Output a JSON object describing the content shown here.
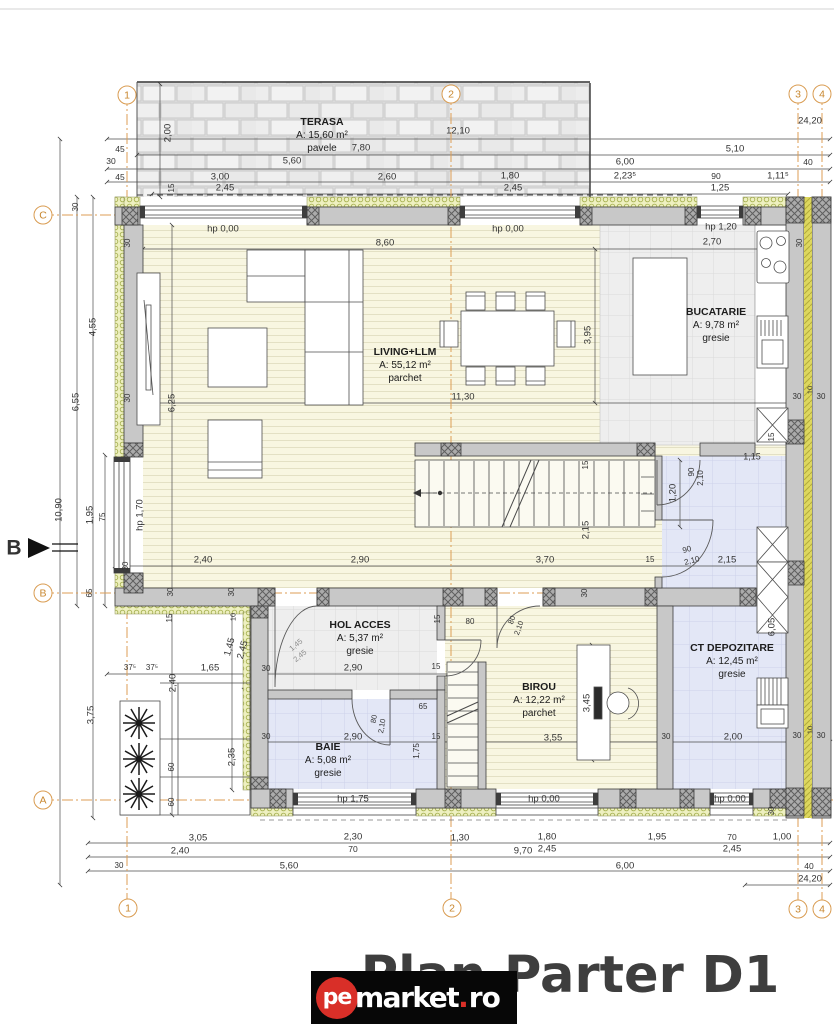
{
  "title": "Plan Parter D1",
  "watermark": {
    "circle_text": "pe",
    "name": "market",
    "tld_dot": ".",
    "tld": "ro"
  },
  "colors": {
    "axis_orange": "#dd9e55",
    "title_gray": "#3e3e3e",
    "watermark_red": "#d92f28",
    "floor_cream": "#f8f6e1",
    "floor_blue": "#e3e7f6",
    "wall_gray": "#c8c8c8",
    "insulation_green": "#eef0c0"
  },
  "grid_bubbles": [
    {
      "label": "1",
      "x": 127,
      "y": 95
    },
    {
      "label": "2",
      "x": 451,
      "y": 94
    },
    {
      "label": "3",
      "x": 798,
      "y": 94
    },
    {
      "label": "4",
      "x": 822,
      "y": 94
    },
    {
      "label": "C",
      "x": 43,
      "y": 215
    },
    {
      "label": "B",
      "x": 43,
      "y": 593
    },
    {
      "label": "A",
      "x": 43,
      "y": 800
    },
    {
      "label": "1",
      "x": 128,
      "y": 908
    },
    {
      "label": "2",
      "x": 452,
      "y": 908
    },
    {
      "label": "3",
      "x": 798,
      "y": 909
    },
    {
      "label": "4",
      "x": 822,
      "y": 909
    }
  ],
  "rooms": [
    {
      "name": "TERASA",
      "area": "A: 15,60 m²",
      "floor": "pavele",
      "x": 322,
      "y": 116
    },
    {
      "name": "LIVING+LLM",
      "area": "A: 55,12 m²",
      "floor": "parchet",
      "x": 405,
      "y": 346
    },
    {
      "name": "BUCATARIE",
      "area": "A: 9,78 m²",
      "floor": "gresie",
      "x": 716,
      "y": 306
    },
    {
      "name": "HOL ACCES",
      "area": "A: 5,37 m²",
      "floor": "gresie",
      "x": 360,
      "y": 619
    },
    {
      "name": "BAIE",
      "area": "A: 5,08 m²",
      "floor": "gresie",
      "x": 328,
      "y": 741
    },
    {
      "name": "BIROU",
      "area": "A: 12,22 m²",
      "floor": "parchet",
      "x": 539,
      "y": 681
    },
    {
      "name": "CT DEPOZITARE",
      "area": "A: 12,45 m²",
      "floor": "gresie",
      "x": 732,
      "y": 642
    }
  ],
  "labels": [
    {
      "t": "12,10",
      "x": 458,
      "y": 131
    },
    {
      "t": "24,20",
      "x": 810,
      "y": 121
    },
    {
      "t": "2,00",
      "x": 168,
      "y": 133,
      "r": -90
    },
    {
      "t": "7,80",
      "x": 361,
      "y": 148
    },
    {
      "t": "5,10",
      "x": 735,
      "y": 149
    },
    {
      "t": "45",
      "x": 120,
      "y": 149,
      "s": 8.5
    },
    {
      "t": "30",
      "x": 111,
      "y": 161,
      "s": 8.5
    },
    {
      "t": "5,60",
      "x": 292,
      "y": 161
    },
    {
      "t": "6,00",
      "x": 625,
      "y": 162
    },
    {
      "t": "40",
      "x": 808,
      "y": 162,
      "s": 8.5
    },
    {
      "t": "45",
      "x": 120,
      "y": 177,
      "s": 8.5
    },
    {
      "t": "3,00",
      "x": 220,
      "y": 177
    },
    {
      "t": "2,60",
      "x": 387,
      "y": 177
    },
    {
      "t": "1,80",
      "x": 510,
      "y": 176
    },
    {
      "t": "2,23⁵",
      "x": 625,
      "y": 176
    },
    {
      "t": "90",
      "x": 716,
      "y": 176,
      "s": 8.5
    },
    {
      "t": "1,11⁵",
      "x": 778,
      "y": 176
    },
    {
      "t": "2,45",
      "x": 225,
      "y": 188
    },
    {
      "t": "15",
      "x": 172,
      "y": 188,
      "r": -90,
      "s": 8
    },
    {
      "t": "2,45",
      "x": 513,
      "y": 188
    },
    {
      "t": "1,25",
      "x": 720,
      "y": 188
    },
    {
      "t": "hp 0,00",
      "x": 223,
      "y": 229
    },
    {
      "t": "hp 0,00",
      "x": 508,
      "y": 229
    },
    {
      "t": "hp 1,20",
      "x": 721,
      "y": 227
    },
    {
      "t": "2,70",
      "x": 712,
      "y": 242
    },
    {
      "t": "8,60",
      "x": 385,
      "y": 243
    },
    {
      "t": "30",
      "x": 128,
      "y": 243,
      "r": -90,
      "s": 8
    },
    {
      "t": "30",
      "x": 800,
      "y": 243,
      "r": -90,
      "s": 8
    },
    {
      "t": "30",
      "x": 76,
      "y": 207,
      "r": -90,
      "s": 8
    },
    {
      "t": "4,55",
      "x": 93,
      "y": 327,
      "r": -90
    },
    {
      "t": "6,55",
      "x": 76,
      "y": 402,
      "r": -90
    },
    {
      "t": "10,90",
      "x": 59,
      "y": 510,
      "r": -90
    },
    {
      "t": "1,95",
      "x": 90,
      "y": 515,
      "r": -90
    },
    {
      "t": "75",
      "x": 103,
      "y": 517,
      "r": -90,
      "s": 8
    },
    {
      "t": "hp 1,70",
      "x": 140,
      "y": 515,
      "r": -90
    },
    {
      "t": "3,75",
      "x": 91,
      "y": 715,
      "r": -90
    },
    {
      "t": "6,25",
      "x": 172,
      "y": 403,
      "r": -90
    },
    {
      "t": "30",
      "x": 128,
      "y": 398,
      "r": -90,
      "s": 8
    },
    {
      "t": "11,30",
      "x": 463,
      "y": 397
    },
    {
      "t": "3,95",
      "x": 588,
      "y": 335,
      "r": -90
    },
    {
      "t": "15",
      "x": 586,
      "y": 465,
      "r": -90,
      "s": 8
    },
    {
      "t": "2,15",
      "x": 586,
      "y": 530,
      "r": -90
    },
    {
      "t": "1,20",
      "x": 673,
      "y": 493,
      "r": -90
    },
    {
      "t": "90",
      "x": 692,
      "y": 472,
      "r": -90,
      "s": 8
    },
    {
      "t": "2,10",
      "x": 701,
      "y": 478,
      "r": -90,
      "s": 8
    },
    {
      "t": "1,15",
      "x": 752,
      "y": 457,
      "s": 9
    },
    {
      "t": "15",
      "x": 772,
      "y": 437,
      "r": -90,
      "s": 8
    },
    {
      "t": "90",
      "x": 687,
      "y": 550,
      "s": 8,
      "r": -15
    },
    {
      "t": "2,10",
      "x": 692,
      "y": 561,
      "s": 8,
      "r": -15
    },
    {
      "t": "10",
      "x": 810,
      "y": 390,
      "r": -90,
      "s": 7.5
    },
    {
      "t": "30",
      "x": 797,
      "y": 397,
      "s": 8
    },
    {
      "t": "30",
      "x": 821,
      "y": 397,
      "s": 8
    },
    {
      "t": "2,40",
      "x": 203,
      "y": 560
    },
    {
      "t": "2,90",
      "x": 360,
      "y": 560
    },
    {
      "t": "3,70",
      "x": 545,
      "y": 560
    },
    {
      "t": "15",
      "x": 650,
      "y": 560,
      "s": 8
    },
    {
      "t": "2,15",
      "x": 727,
      "y": 560
    },
    {
      "t": "30",
      "x": 126,
      "y": 566,
      "r": -90,
      "s": 8
    },
    {
      "t": "65",
      "x": 90,
      "y": 593,
      "r": -90,
      "s": 8
    },
    {
      "t": "30",
      "x": 171,
      "y": 592,
      "r": -90,
      "s": 8
    },
    {
      "t": "30",
      "x": 232,
      "y": 592,
      "r": -90,
      "s": 8
    },
    {
      "t": "30",
      "x": 585,
      "y": 593,
      "r": -90,
      "s": 8
    },
    {
      "t": "15",
      "x": 170,
      "y": 618,
      "r": -90,
      "s": 8
    },
    {
      "t": "10",
      "x": 233,
      "y": 617,
      "r": -90,
      "s": 7.5
    },
    {
      "t": "80",
      "x": 470,
      "y": 622,
      "s": 8
    },
    {
      "t": "15",
      "x": 438,
      "y": 619,
      "r": -90,
      "s": 8
    },
    {
      "t": "1,45",
      "x": 230,
      "y": 647,
      "r": -75
    },
    {
      "t": "2,45",
      "x": 243,
      "y": 650,
      "r": -75
    },
    {
      "t": "1,45",
      "x": 296,
      "y": 645,
      "r": -40,
      "s": 7.5,
      "c": "#8a8a8a"
    },
    {
      "t": "2,45",
      "x": 300,
      "y": 656,
      "r": -40,
      "s": 7.5,
      "c": "#8a8a8a"
    },
    {
      "t": "80",
      "x": 512,
      "y": 620,
      "r": -70,
      "s": 7.5
    },
    {
      "t": "2,10",
      "x": 519,
      "y": 628,
      "r": -70,
      "s": 7.5
    },
    {
      "t": "37⁵",
      "x": 130,
      "y": 668,
      "s": 8
    },
    {
      "t": "37⁵",
      "x": 152,
      "y": 668,
      "s": 8
    },
    {
      "t": "1,65",
      "x": 210,
      "y": 668
    },
    {
      "t": "30",
      "x": 266,
      "y": 669,
      "s": 8
    },
    {
      "t": "2,90",
      "x": 353,
      "y": 668
    },
    {
      "t": "15",
      "x": 436,
      "y": 667,
      "s": 8
    },
    {
      "t": "2,40",
      "x": 173,
      "y": 683,
      "r": -90
    },
    {
      "t": "65",
      "x": 423,
      "y": 707,
      "s": 8
    },
    {
      "t": "80",
      "x": 374,
      "y": 719,
      "r": -80,
      "s": 7.5
    },
    {
      "t": "2,10",
      "x": 382,
      "y": 726,
      "r": -80,
      "s": 7.5
    },
    {
      "t": "30",
      "x": 266,
      "y": 737,
      "s": 8
    },
    {
      "t": "2,90",
      "x": 353,
      "y": 737
    },
    {
      "t": "15",
      "x": 436,
      "y": 737,
      "s": 8
    },
    {
      "t": "1,75",
      "x": 417,
      "y": 751,
      "r": -90,
      "s": 8
    },
    {
      "t": "2,35",
      "x": 232,
      "y": 757,
      "r": -90
    },
    {
      "t": "60",
      "x": 172,
      "y": 767,
      "r": -90,
      "s": 8
    },
    {
      "t": "60",
      "x": 172,
      "y": 802,
      "r": -90,
      "s": 8
    },
    {
      "t": "hp 1,75",
      "x": 353,
      "y": 799
    },
    {
      "t": "3,45",
      "x": 587,
      "y": 703,
      "r": -90
    },
    {
      "t": "3,55",
      "x": 553,
      "y": 738
    },
    {
      "t": "30",
      "x": 666,
      "y": 737,
      "s": 8
    },
    {
      "t": "2,00",
      "x": 733,
      "y": 737
    },
    {
      "t": "30",
      "x": 797,
      "y": 736,
      "s": 8
    },
    {
      "t": "30",
      "x": 821,
      "y": 736,
      "s": 8
    },
    {
      "t": "10",
      "x": 810,
      "y": 730,
      "r": -90,
      "s": 7.5
    },
    {
      "t": "6,05",
      "x": 772,
      "y": 627,
      "r": -90
    },
    {
      "t": "hp 0,00",
      "x": 544,
      "y": 799
    },
    {
      "t": "hp 0,00",
      "x": 730,
      "y": 799
    },
    {
      "t": "30",
      "x": 772,
      "y": 811,
      "r": -90,
      "s": 8
    },
    {
      "t": "3,05",
      "x": 198,
      "y": 838
    },
    {
      "t": "2,30",
      "x": 353,
      "y": 837
    },
    {
      "t": "70",
      "x": 353,
      "y": 849,
      "s": 8.5
    },
    {
      "t": "1,30",
      "x": 460,
      "y": 838
    },
    {
      "t": "1,80",
      "x": 547,
      "y": 837
    },
    {
      "t": "2,45",
      "x": 547,
      "y": 849
    },
    {
      "t": "9,70",
      "x": 523,
      "y": 851
    },
    {
      "t": "1,95",
      "x": 657,
      "y": 837
    },
    {
      "t": "70",
      "x": 732,
      "y": 837,
      "s": 8.5
    },
    {
      "t": "2,45",
      "x": 732,
      "y": 849
    },
    {
      "t": "1,00",
      "x": 782,
      "y": 837
    },
    {
      "t": "2,40",
      "x": 180,
      "y": 851
    },
    {
      "t": "30",
      "x": 119,
      "y": 866,
      "s": 8
    },
    {
      "t": "5,60",
      "x": 289,
      "y": 866
    },
    {
      "t": "6,00",
      "x": 625,
      "y": 866
    },
    {
      "t": "40",
      "x": 809,
      "y": 866,
      "s": 8.5
    },
    {
      "t": "24,20",
      "x": 810,
      "y": 879
    },
    {
      "t": "B",
      "x": 14,
      "y": 548,
      "s": 21,
      "b": 1
    }
  ]
}
